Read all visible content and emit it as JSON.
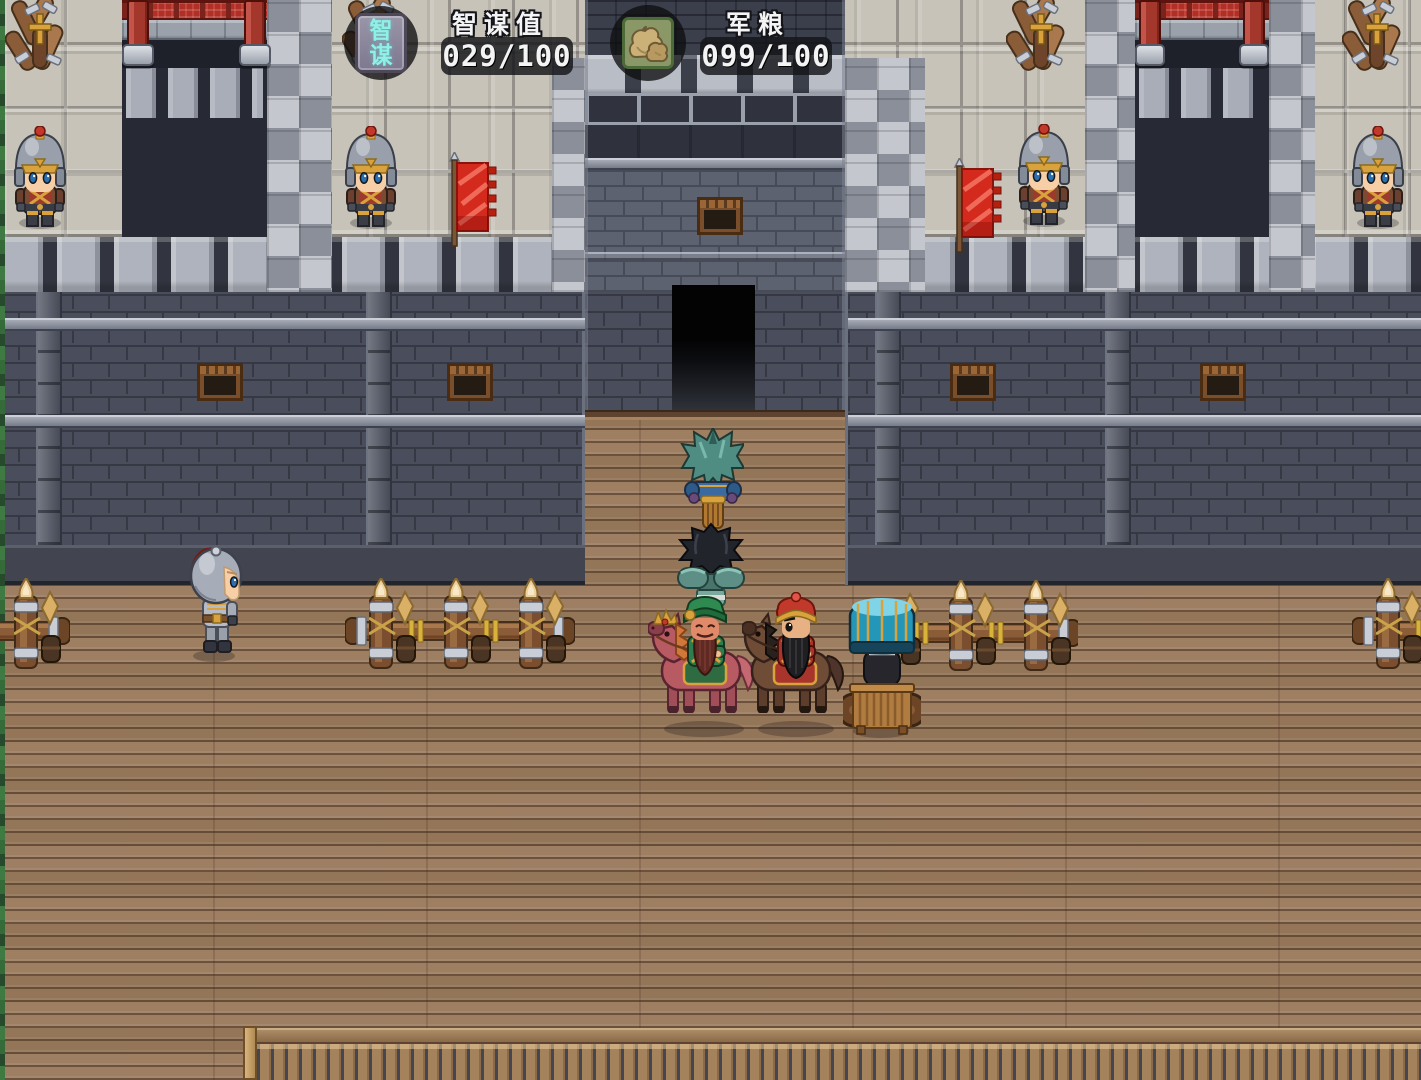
{
  "hud": {
    "strategy": {
      "badge_char_top": "智",
      "badge_char_bottom": "谋",
      "label": "智谋值",
      "value": "029/100"
    },
    "provisions": {
      "label": "军粮",
      "value": "099/100",
      "icon": "grain-sacks-icon"
    }
  },
  "palette": {
    "badge_glyph": "#8ff0e6",
    "hud_text": "#f4f4f5",
    "flag_red": "#d42a1e",
    "pillar_red": "#a4372b",
    "wall_dark_brick": "#4a4e5c",
    "gatehouse_brick": "#5d6271",
    "walkway_tile": "#c7c3b8",
    "floor_wood": "#9a7a5c",
    "gold_trim": "#d9a23c"
  }
}
